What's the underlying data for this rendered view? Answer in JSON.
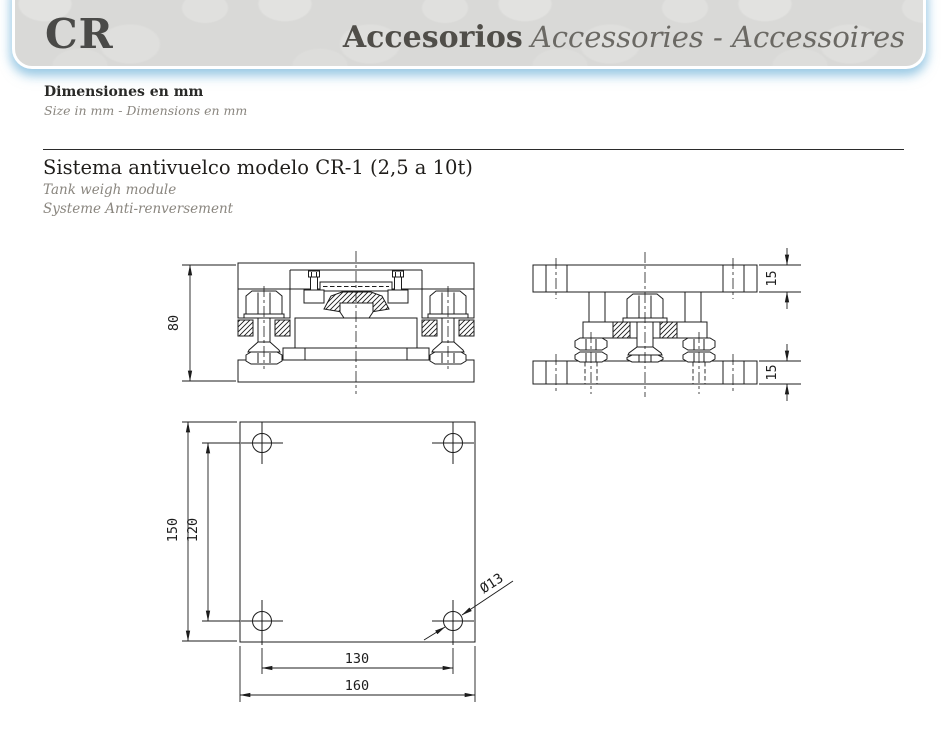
{
  "header": {
    "code": "CR",
    "title_primary": "Accesorios",
    "title_translations": "Accessories - Accessoires"
  },
  "units_note": {
    "primary": "Dimensiones en mm",
    "secondary": "Size in mm  -  Dimensions en mm"
  },
  "section": {
    "title": "Sistema antivuelco modelo CR-1 (2,5 a 10t)",
    "subtitle_en": "Tank weigh module",
    "subtitle_fr": "Systeme Anti-renversement"
  },
  "drawing": {
    "dims": {
      "front_height": "80",
      "top_plate_thickness": "15",
      "bottom_plate_thickness": "15",
      "plate_height": "150",
      "hole_pitch_vertical": "120",
      "hole_pitch_horizontal": "130",
      "plate_width": "160",
      "hole_diameter": "Ø13"
    }
  }
}
